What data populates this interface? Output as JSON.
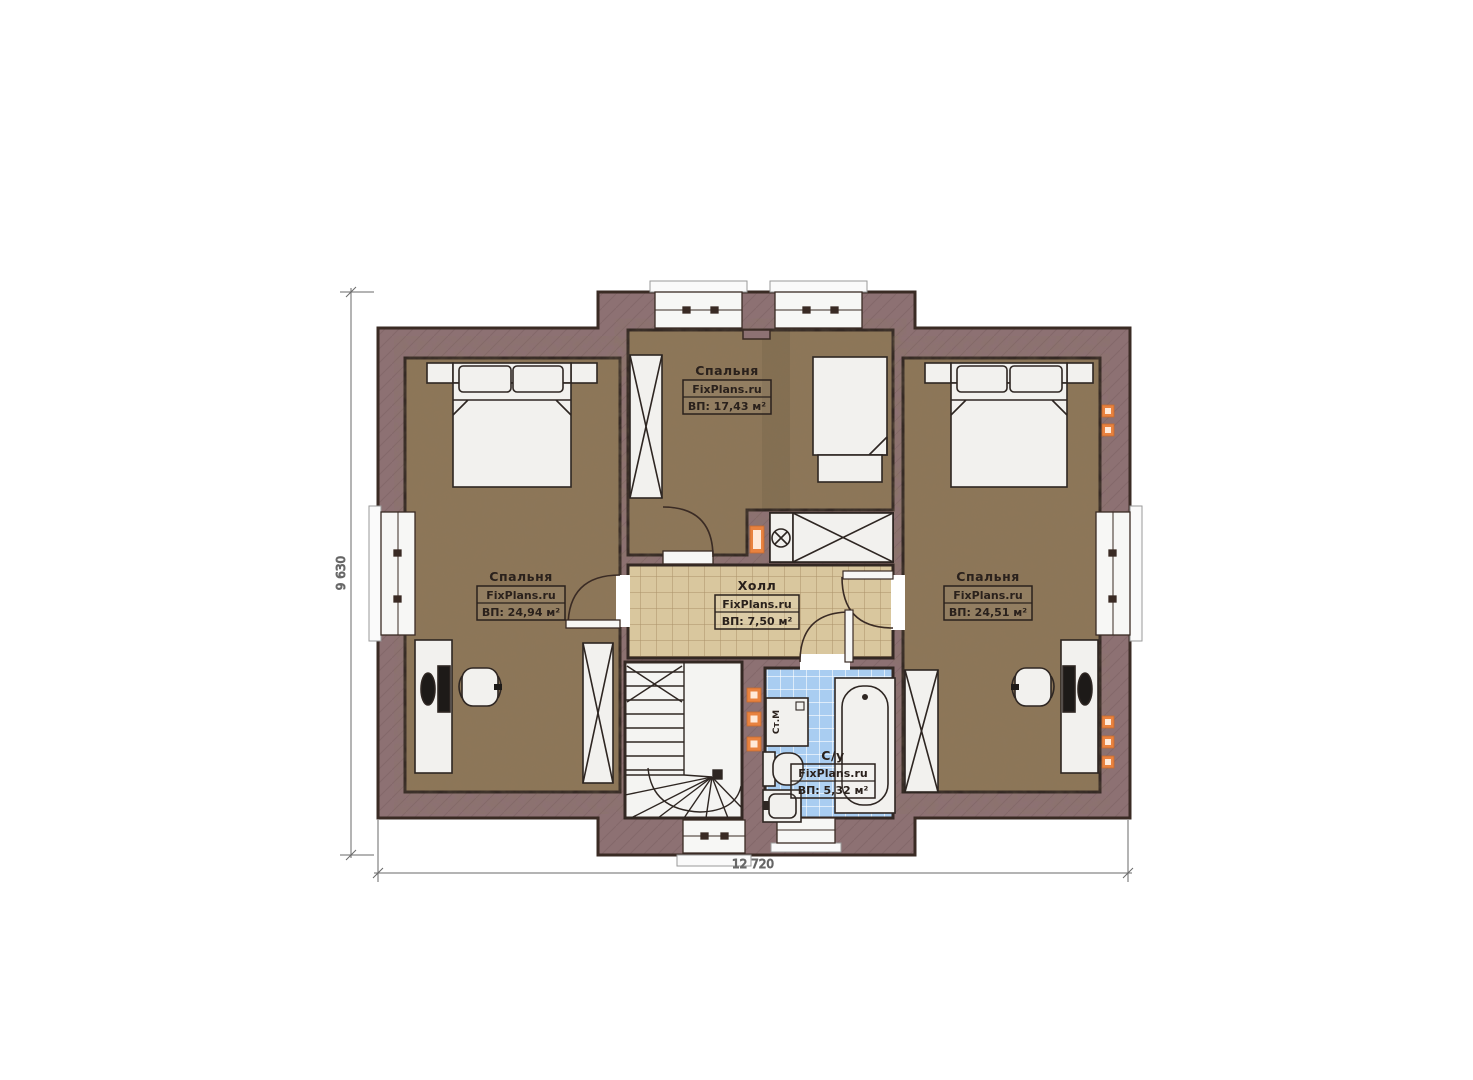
{
  "plan": {
    "type": "floor-plan",
    "source_brand": "FixPlans.ru",
    "dimensions": {
      "width_label": "12 720",
      "height_label": "9 630"
    },
    "rooms": {
      "bedroom_top": {
        "name": "Спальня",
        "brand": "FixPlans.ru",
        "area": "ВП: 17,43 м²"
      },
      "bedroom_left": {
        "name": "Спальня",
        "brand": "FixPlans.ru",
        "area": "ВП: 24,94 м²"
      },
      "bedroom_right": {
        "name": "Спальня",
        "brand": "FixPlans.ru",
        "area": "ВП: 24,51 м²"
      },
      "hall": {
        "name": "Холл",
        "brand": "FixPlans.ru",
        "area": "ВП: 7,50 м²"
      },
      "bathroom": {
        "name": "С/у",
        "brand": "FixPlans.ru",
        "area": "ВП: 5,32 м²"
      }
    },
    "appliances": {
      "washing_machine": "Ст.М"
    },
    "colors": {
      "wall": "#8d7173",
      "bedroom_floor": "#8d7658",
      "hall_floor": "#d9c79e",
      "bathroom_floor": "#a9cdf1",
      "stair_floor": "#f4f4f2",
      "furniture": "#f2f1ee",
      "outline": "#3a2b24",
      "socket": "#e8823f"
    }
  }
}
